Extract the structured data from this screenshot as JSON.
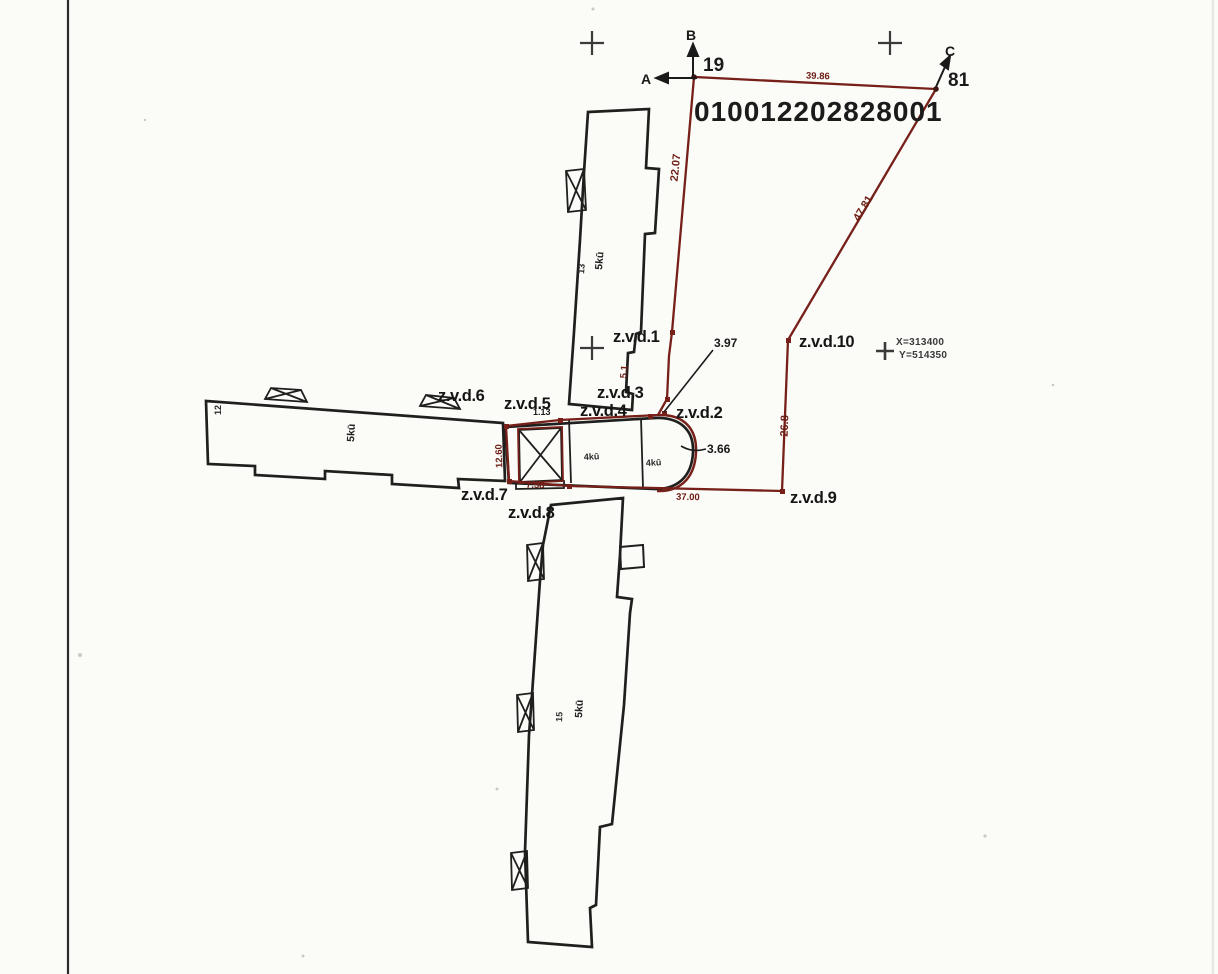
{
  "parcel": {
    "number": "010012202828001"
  },
  "corners": {
    "a": "A",
    "b": "B",
    "c": "C",
    "b_point": "19",
    "c_point": "81"
  },
  "grid": {
    "x_coord": "X=313400",
    "y_coord": "Y=514350"
  },
  "points": [
    "z.v.d.1",
    "z.v.d.2",
    "z.v.d.3",
    "z.v.d.4",
    "z.v.d.5",
    "z.v.d.6",
    "z.v.d.7",
    "z.v.d.8",
    "z.v.d.9",
    "z.v.d.10"
  ],
  "dimensions": {
    "top": "39.86",
    "west": "22.07",
    "diagonal": "47.81",
    "east": "26.8",
    "south": "37.00",
    "corner_offset": "3.97",
    "arc_offset": "3.66",
    "small_offset": "1.13",
    "stair_width": "12.60",
    "south_west": "7.58",
    "west_lower": "5.1"
  },
  "buildings": {
    "north": {
      "num": "13",
      "type": "5kū"
    },
    "west": {
      "num": "12",
      "type": "5kū"
    },
    "middle": {
      "type_a": "4kū",
      "type_b": "4kū"
    },
    "south": {
      "num": "15",
      "type": "5kū"
    }
  },
  "colors": {
    "boundary": "#77201a",
    "ink": "#1f1f1e",
    "paper": "#fbfbf8"
  }
}
